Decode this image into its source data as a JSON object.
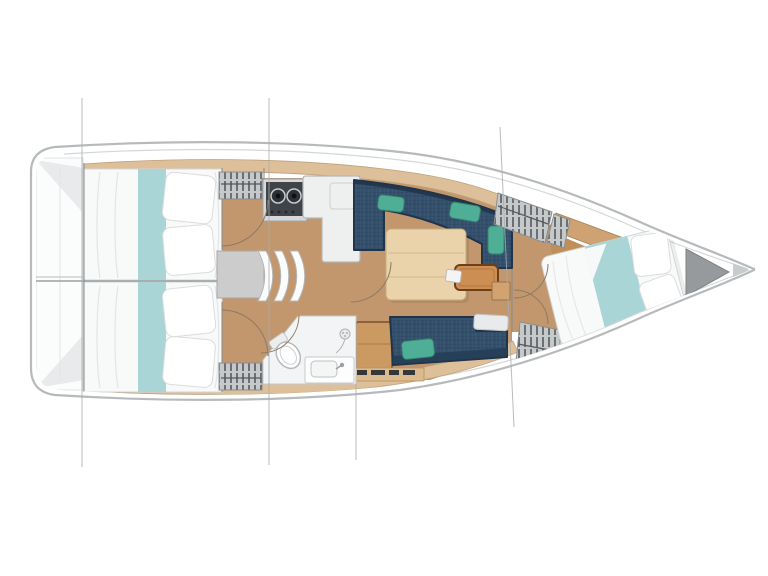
{
  "meta": {
    "content_type": "yacht-interior-floor-plan",
    "orientation": "bow-right-stern-left",
    "visible_text": "none",
    "rig_line_count": 4
  },
  "colors": {
    "hullOutline": "#b6babc",
    "hullFill": "#ffffff",
    "roofLine": "#d4d7d8",
    "deckWood": "#ddbf99",
    "floorWood": "#c2976d",
    "mattress": "#f8f9f9",
    "beddingTeal": "#a9d5d7",
    "sofaNavy": "#33506d",
    "sofaNavyDark": "#20344a",
    "cushionGreen": "#4fae96",
    "tableWood": "#ead3aa",
    "trayBrown": "#cd8e53",
    "lockerGray": "#c6c9ca",
    "lockerHatch": "#55595e",
    "stoveDark": "#3f4448",
    "engineGray": "#cccccc",
    "bathFloor": "#f3f4f5",
    "doorArc": "#8b7a64",
    "rigLine": "#a8acae",
    "bowLocker": "#969a9c",
    "transomPanel": "#fbfcfc"
  },
  "rooms": [
    {
      "id": "aft-cabin-port",
      "label": "Aft cabin (port)",
      "furniture": [
        "double-berth",
        "teal-runner",
        "pillows",
        "hanging-locker"
      ]
    },
    {
      "id": "aft-cabin-starboard",
      "label": "Aft cabin (starboard)",
      "furniture": [
        "double-berth",
        "teal-runner",
        "pillows",
        "hanging-locker"
      ]
    },
    {
      "id": "companionway",
      "label": "Companionway",
      "furniture": [
        "three-curved-steps",
        "engine-compartment"
      ]
    },
    {
      "id": "galley",
      "label": "Galley",
      "furniture": [
        "two-burner-stove",
        "l-shaped-counter-with-sink"
      ]
    },
    {
      "id": "salon",
      "label": "Salon",
      "furniture": [
        "l-shaped-sofa",
        "green-cushions",
        "dining-table",
        "side-tray-table",
        "instrument-device",
        "starboard-settee",
        "wooden-cabinet",
        "shelf-with-items"
      ]
    },
    {
      "id": "head",
      "label": "Head / bathroom",
      "furniture": [
        "toilet",
        "sink-vanity",
        "shower-head"
      ]
    },
    {
      "id": "forward-cabin",
      "label": "Forward cabin",
      "furniture": [
        "angled-double-berth",
        "teal-runner",
        "pillows",
        "hanging-locker",
        "hanging-locker",
        "wood-shelf"
      ]
    },
    {
      "id": "bow",
      "label": "Bow",
      "furniture": [
        "anchor-locker"
      ]
    },
    {
      "id": "stern",
      "label": "Stern platform",
      "furniture": []
    }
  ]
}
